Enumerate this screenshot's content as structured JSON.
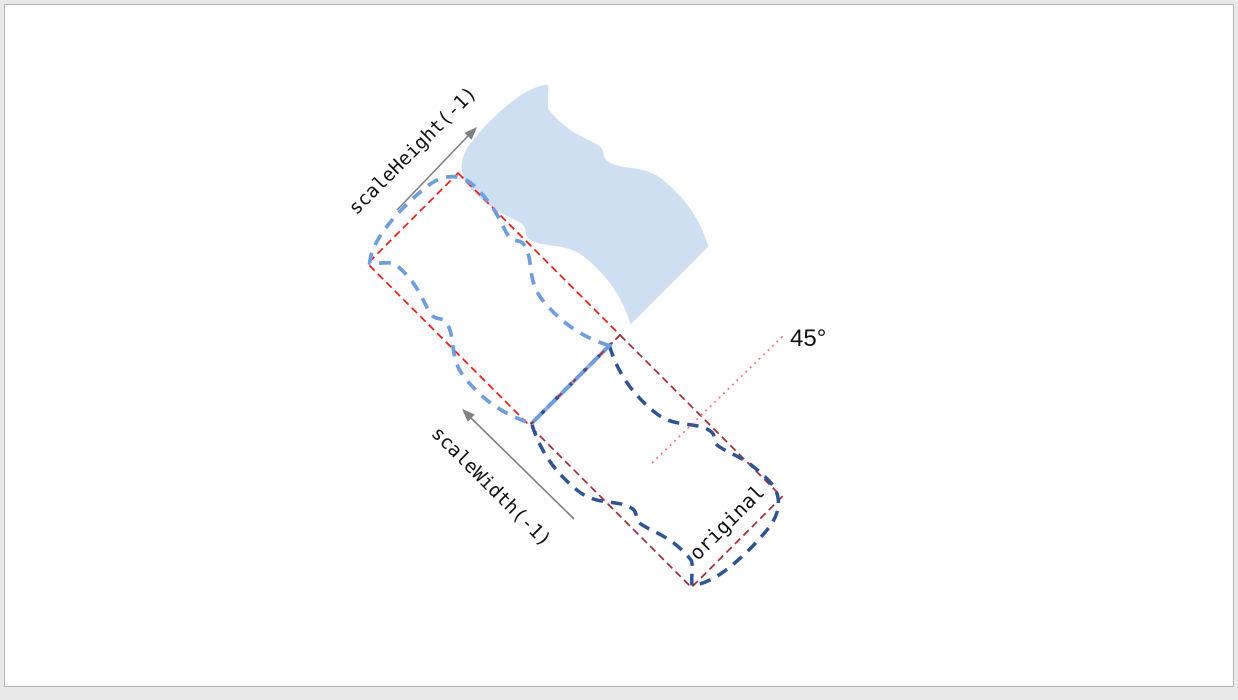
{
  "canvas": {
    "background": "#ffffff",
    "frame": "#e9e9e9",
    "border": "#b5b5b5"
  },
  "diagram": {
    "labels": {
      "scale_height": "scaleHeight(-1)",
      "scale_width": "scaleWidth(-1)",
      "original": "original",
      "angle": "45°"
    },
    "colors": {
      "flag_fill": "#cedff2",
      "flag_original_stroke": "#2f5496",
      "flag_scalewidth_stroke": "#6f9ede",
      "box_scalewidth_stroke": "#f51515",
      "box_original_stroke": "#a52a35",
      "shared_edge": "#8cafe6",
      "angle_line": "#ff6b6b",
      "arrow": "#7f7f7f"
    }
  }
}
